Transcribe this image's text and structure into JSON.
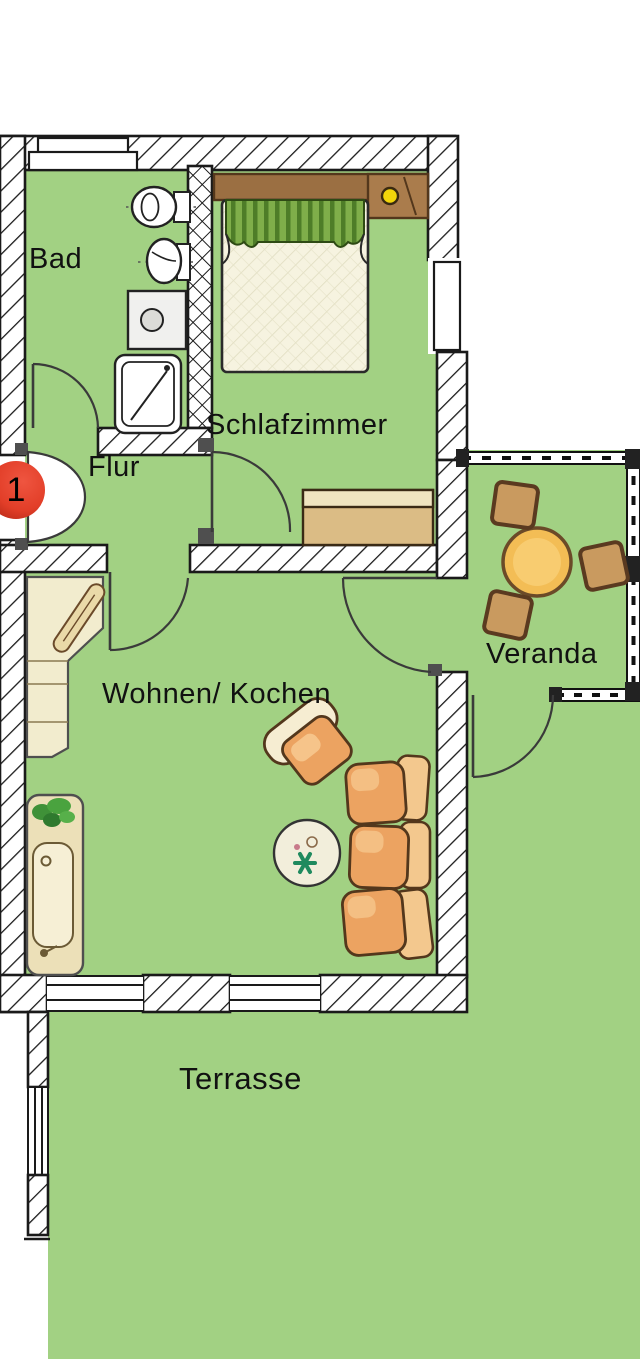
{
  "plan": {
    "title": "apartment-floor-plan",
    "unit_badge": "1",
    "rooms": {
      "bad": "Bad",
      "flur": "Flur",
      "schlafzimmer": "Schlafzimmer",
      "wohnen_kochen": "Wohnen/ Kochen",
      "veranda": "Veranda",
      "terrasse": "Terrasse"
    },
    "colors": {
      "floor_green": "#a2d183",
      "wall_fill": "#ffffff",
      "wall_line": "#1a1a1a",
      "badge_red": "#e23e28",
      "furniture_wood": "#c9995f",
      "table_top_yellow": "#f3bd55",
      "lamp_yellow": "#f2d50a",
      "sofa_orange": "#eca361",
      "counter_cream": "#f2ecce",
      "curtain_green": "#6f9e3e"
    },
    "furniture_icons": [
      "bed",
      "headboard-shelf",
      "bedside-lamp",
      "curtain",
      "dresser",
      "toilet",
      "washbasin",
      "washing-machine",
      "shower",
      "kitchen-counter",
      "cutting-board",
      "kitchen-sink-unit",
      "plant",
      "armchair",
      "sofa",
      "coffee-table",
      "veranda-table",
      "stool",
      "stool",
      "stool"
    ],
    "doors": [
      "entrance-door",
      "bath-door",
      "bedroom-door",
      "living-room-door",
      "veranda-door",
      "terrace-door"
    ]
  }
}
